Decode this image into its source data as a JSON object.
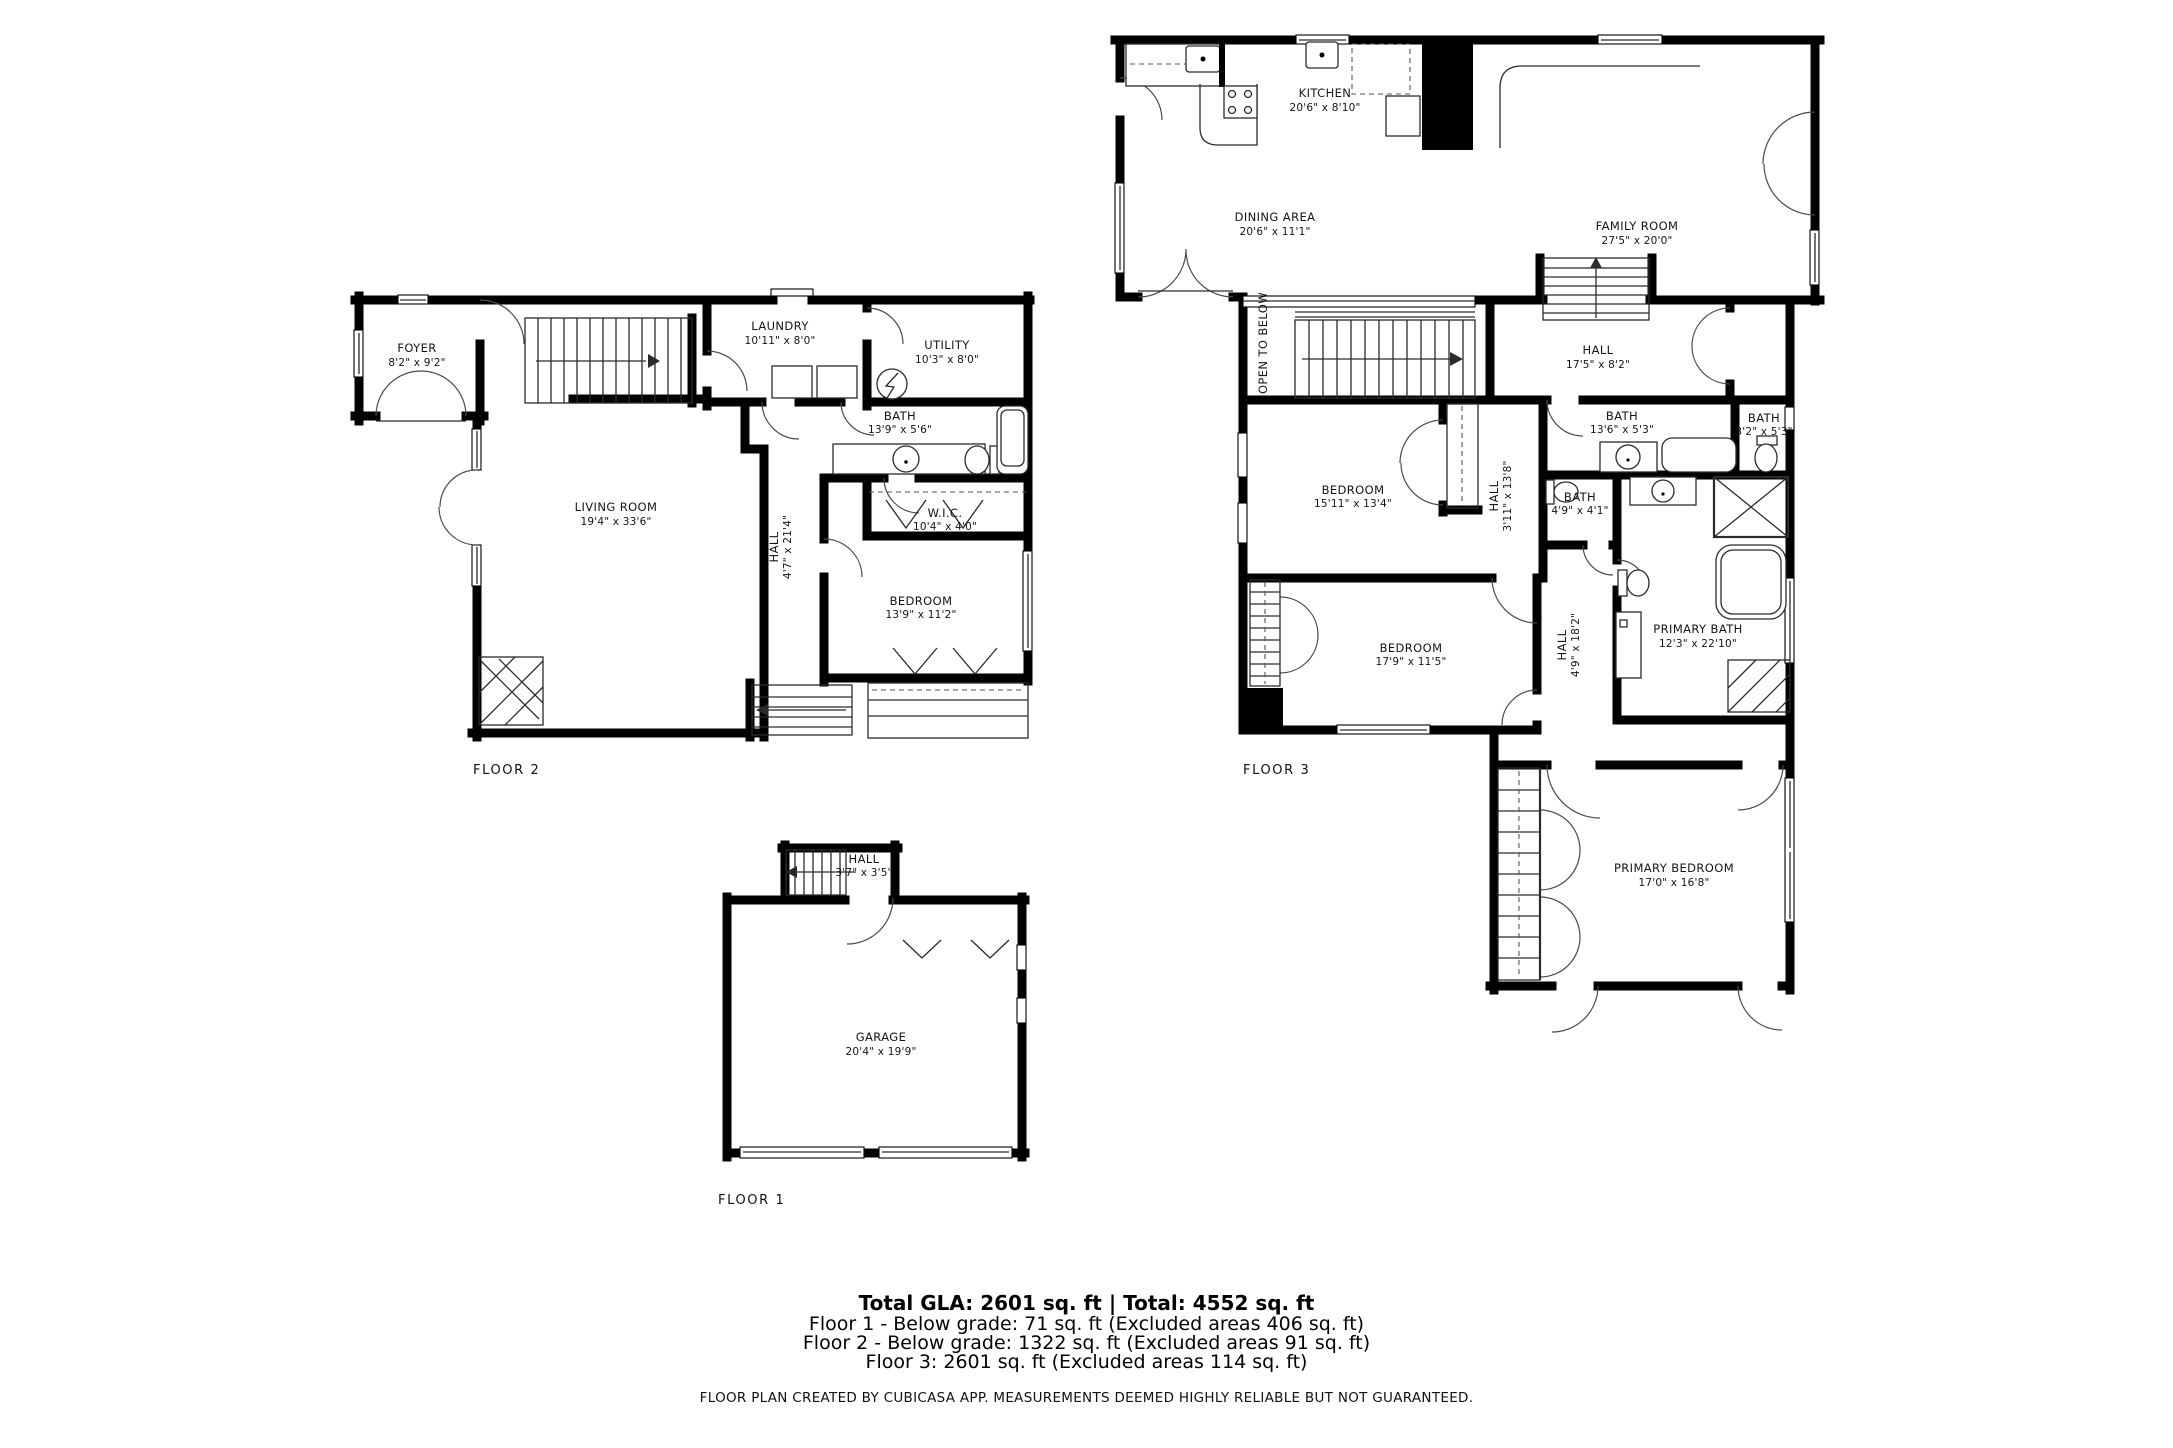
{
  "floors": [
    {
      "label": "FLOOR 1",
      "rooms": [
        {
          "name": "HALL",
          "dims": "3'7\" x 3'5\""
        },
        {
          "name": "GARAGE",
          "dims": "20'4\" x 19'9\""
        }
      ]
    },
    {
      "label": "FLOOR 2",
      "rooms": [
        {
          "name": "FOYER",
          "dims": "8'2\" x 9'2\""
        },
        {
          "name": "LAUNDRY",
          "dims": "10'11\" x 8'0\""
        },
        {
          "name": "UTILITY",
          "dims": "10'3\" x 8'0\""
        },
        {
          "name": "BATH",
          "dims": "13'9\" x 5'6\""
        },
        {
          "name": "W.I.C.",
          "dims": "10'4\" x 4'0\""
        },
        {
          "name": "LIVING ROOM",
          "dims": "19'4\" x 33'6\""
        },
        {
          "name": "HALL",
          "dims": "4'7\" x 21'4\""
        },
        {
          "name": "BEDROOM",
          "dims": "13'9\" x 11'2\""
        }
      ]
    },
    {
      "label": "FLOOR 3",
      "rooms": [
        {
          "name": "KITCHEN",
          "dims": "20'6\" x 8'10\""
        },
        {
          "name": "DINING AREA",
          "dims": "20'6\" x 11'1\""
        },
        {
          "name": "FAMILY ROOM",
          "dims": "27'5\" x 20'0\""
        },
        {
          "name": "HALL",
          "dims": "17'5\" x 8'2\""
        },
        {
          "name": "OPEN TO BELOW",
          "dims": ""
        },
        {
          "name": "BEDROOM",
          "dims": "15'11\" x 13'4\""
        },
        {
          "name": "BATH",
          "dims": "13'6\" x 5'3\""
        },
        {
          "name": "BATH",
          "dims": "3'2\" x 5'3\""
        },
        {
          "name": "BATH",
          "dims": "4'9\" x 4'1\""
        },
        {
          "name": "HALL",
          "dims": "3'11\" x 13'8\""
        },
        {
          "name": "BEDROOM",
          "dims": "17'9\" x 11'5\""
        },
        {
          "name": "HALL",
          "dims": "4'9\" x 18'2\""
        },
        {
          "name": "PRIMARY BATH",
          "dims": "12'3\" x 22'10\""
        },
        {
          "name": "PRIMARY BEDROOM",
          "dims": "17'0\" x 16'8\""
        }
      ]
    }
  ],
  "summary": {
    "total": "Total GLA: 2601 sq. ft | Total: 4552 sq. ft",
    "floor_lines": [
      "Floor 1 - Below grade: 71 sq. ft (Excluded areas 406 sq. ft)",
      "Floor 2 - Below grade: 1322 sq. ft (Excluded areas 91 sq. ft)",
      "Floor 3: 2601 sq. ft (Excluded areas 114 sq. ft)"
    ],
    "disclaimer": "FLOOR PLAN CREATED BY CUBICASA APP. MEASUREMENTS DEEMED HIGHLY RELIABLE BUT NOT GUARANTEED."
  }
}
